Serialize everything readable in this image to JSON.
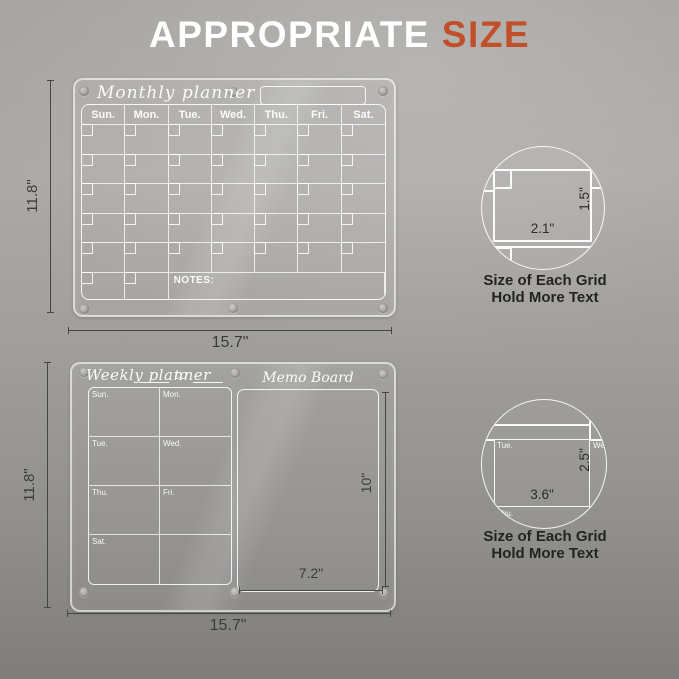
{
  "title": {
    "main": "APPROPRIATE",
    "accent": "SIZE",
    "accent_color": "#c1502a"
  },
  "monthly": {
    "name": "Monthly planner",
    "days": [
      "Sun.",
      "Mon.",
      "Tue.",
      "Wed.",
      "Thu.",
      "Fri.",
      "Sat."
    ],
    "notes_label": "NOTES:",
    "width_label": "15.7\"",
    "height_label": "11.8\""
  },
  "weekly": {
    "name": "Weekly planner",
    "to_label": "to",
    "memo_label": "Memo Board",
    "days": [
      "Sun.",
      "Mon.",
      "Tue.",
      "Wed.",
      "Thu.",
      "Fri.",
      "Sat."
    ],
    "memo_height_label": "10\"",
    "memo_width_label": "7.2\"",
    "width_label": "15.7\"",
    "height_label": "11.8\""
  },
  "detail_top": {
    "grid_width_label": "2.1\"",
    "grid_height_label": "1.5\"",
    "caption_line1": "Size of Each Grid",
    "caption_line2": "Hold More Text"
  },
  "detail_bottom": {
    "day_label": "Tue.",
    "day_label_partial": "We",
    "day_label_below": "Thu.",
    "grid_width_label": "3.6\"",
    "grid_height_label": "2.5\"",
    "caption_line1": "Size of Each Grid",
    "caption_line2": "Hold More Text"
  }
}
